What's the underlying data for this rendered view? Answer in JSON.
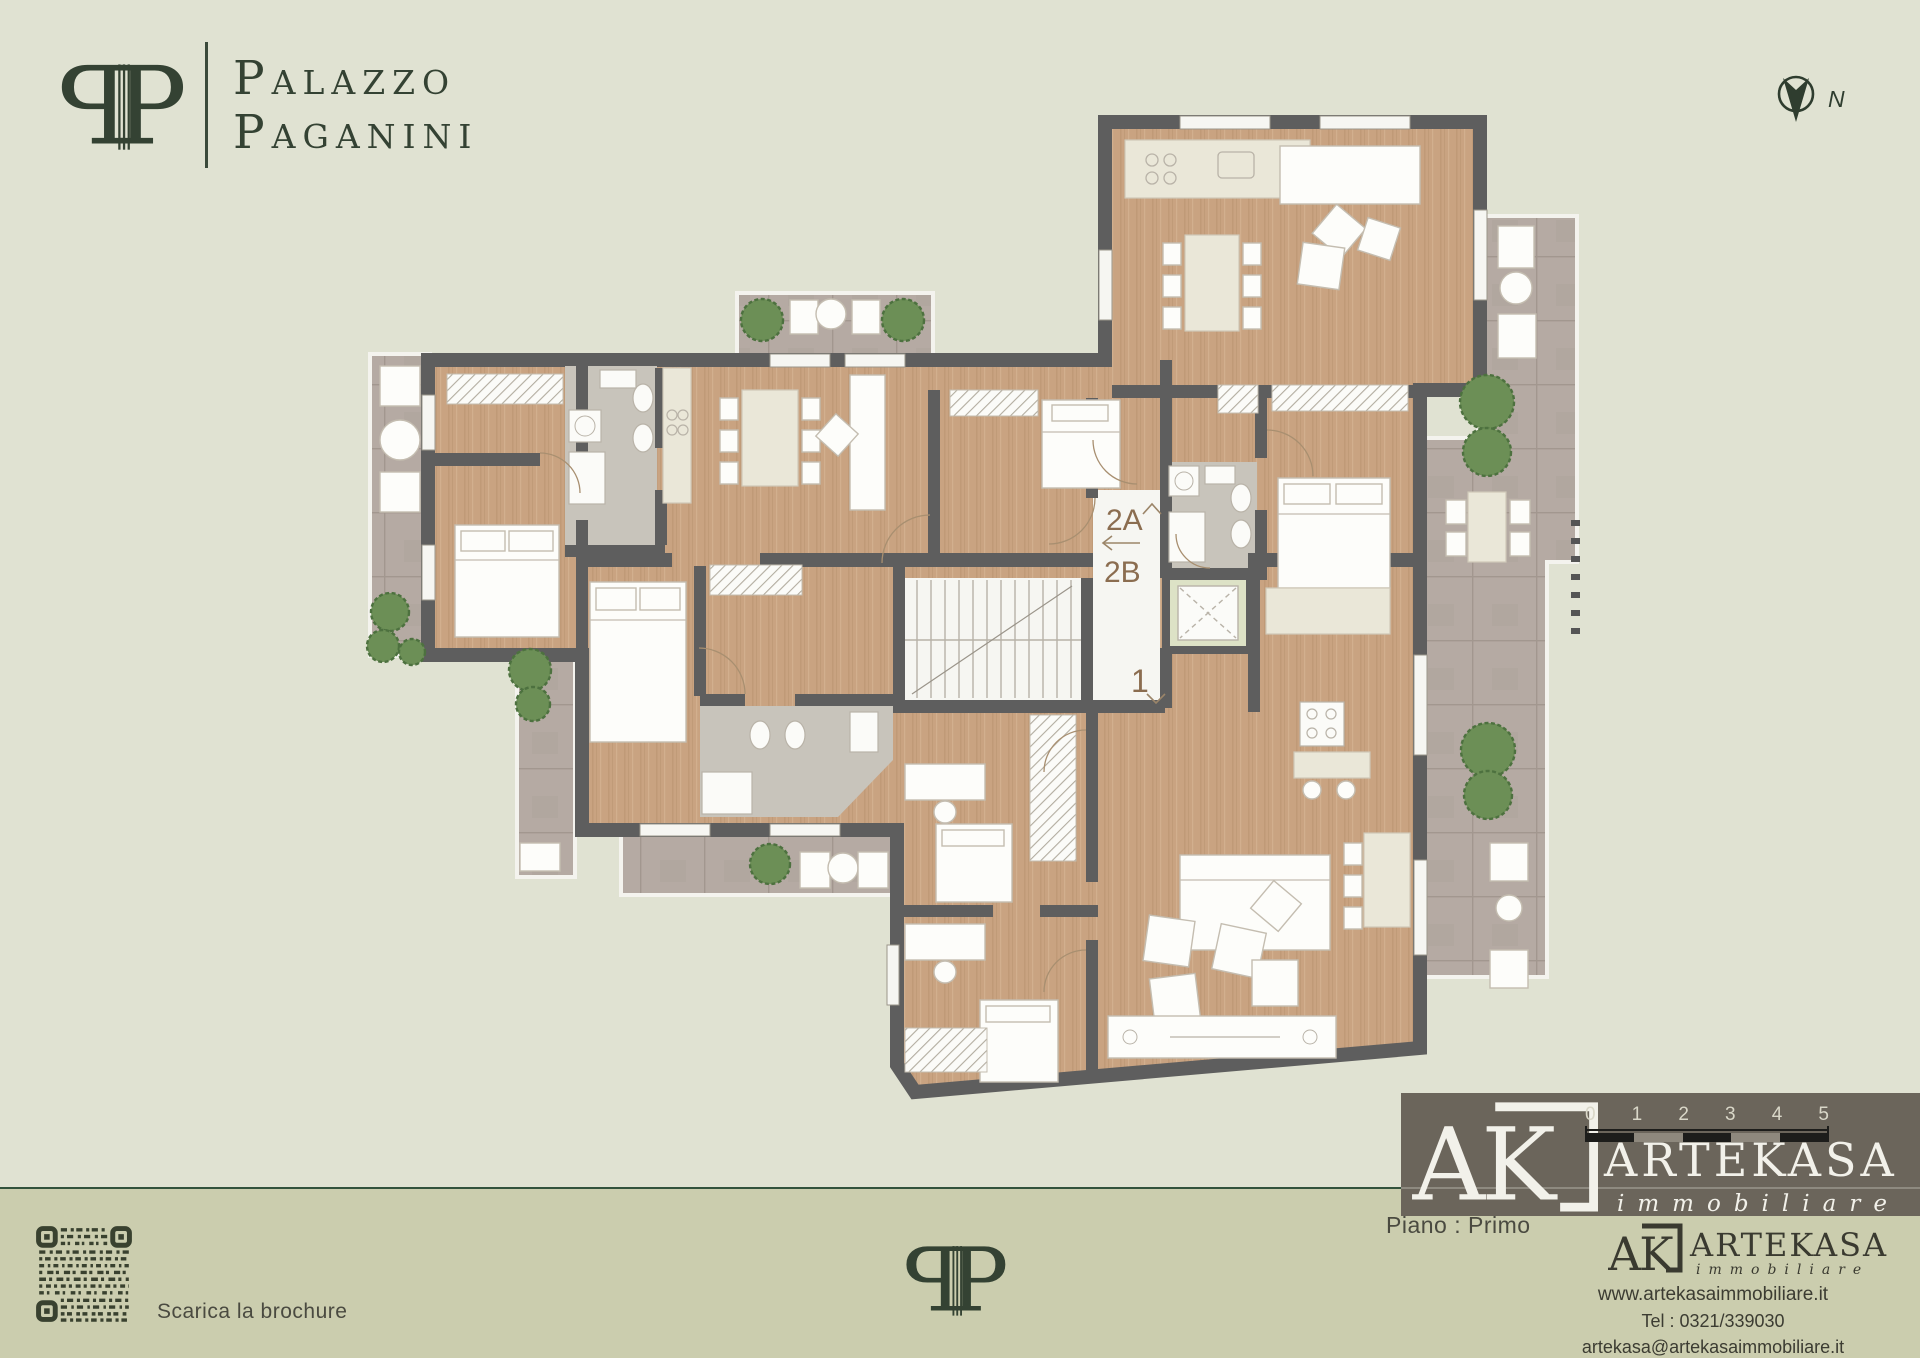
{
  "brand": {
    "monogram_letter": "P",
    "name_line1": "Palazzo",
    "name_line2": "Paganini"
  },
  "compass": {
    "north_label": "N"
  },
  "plan": {
    "units": [
      {
        "label": "2A"
      },
      {
        "label": "2B"
      },
      {
        "label": "1"
      }
    ]
  },
  "footer": {
    "brochure_label": "Scarica la brochure",
    "floor_label": "Piano : Primo",
    "scalebar": {
      "labels": [
        "0",
        "1",
        "2",
        "3",
        "4",
        "5"
      ]
    },
    "agency": {
      "initials": "AK",
      "name": "ARTEKASA",
      "subtitle": "immobiliare",
      "website": "www.artekasaimmobiliare.it",
      "phone": "Tel : 0321/339030",
      "email": "artekasa@artekasaimmobiliare.it"
    }
  },
  "colors": {
    "background": "#e0e2d2",
    "footer_band": "#cbcdae",
    "divider": "#33523c",
    "brand_green": "#344233",
    "wall": "#5e5e5e",
    "wood": "#c9a381",
    "terrace": "#b5aaa3",
    "unit_label": "#8b6d50",
    "agency_box": "#6b655b"
  }
}
